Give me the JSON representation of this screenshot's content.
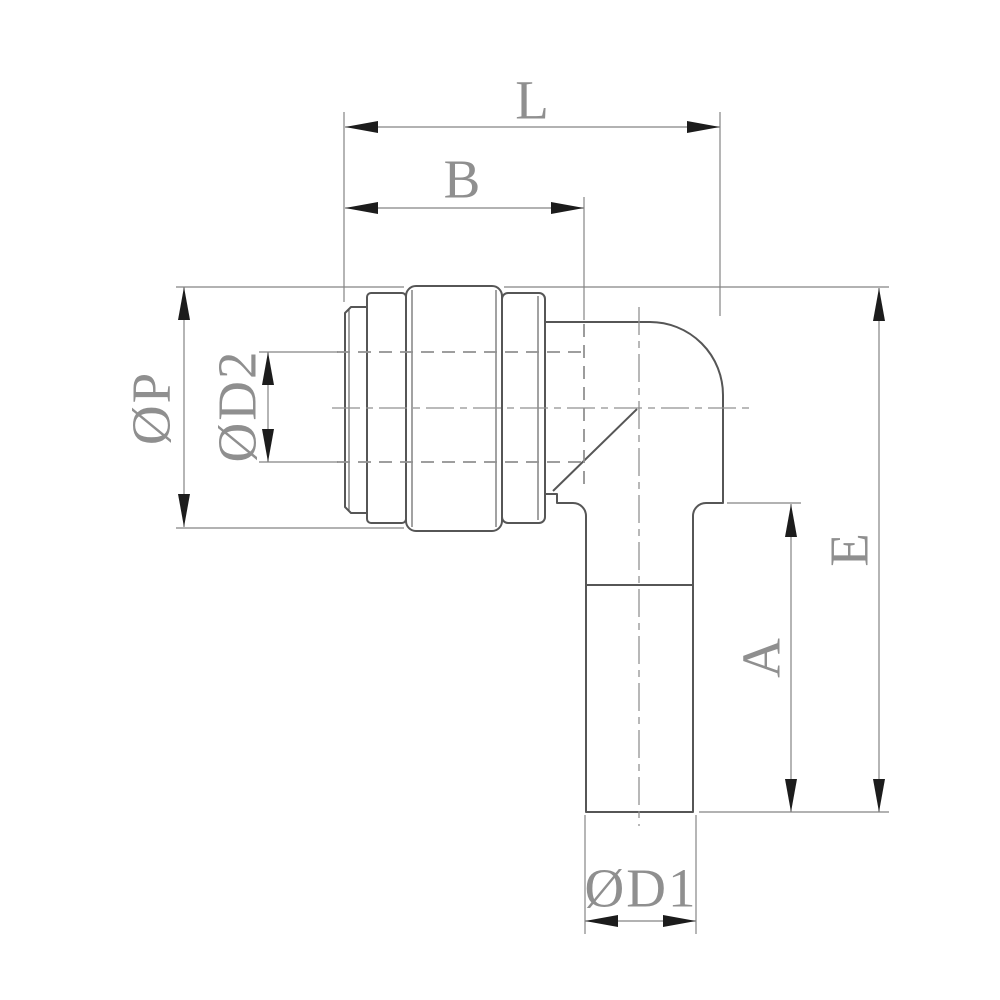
{
  "drawing": {
    "labels": {
      "L": "L",
      "B": "B",
      "P": "ØP",
      "D2": "ØD2",
      "E": "E",
      "A": "A",
      "D1": "ØD1"
    },
    "colors": {
      "background": "#ffffff",
      "outline": "#565656",
      "dimension": "#848484",
      "hidden": "#919191",
      "arrow": "#1c1c1c",
      "text": "#8f8f8f"
    }
  }
}
